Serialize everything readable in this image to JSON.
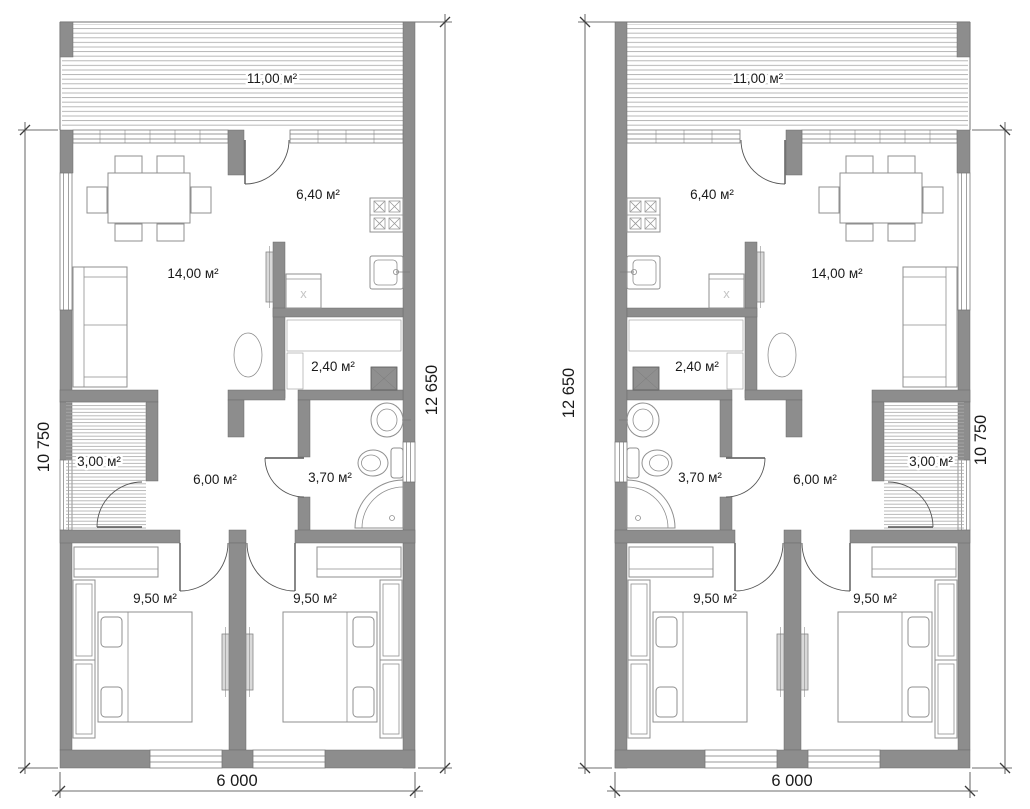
{
  "drawing": {
    "type": "architectural floor plan, two mirrored units",
    "units": "м²"
  },
  "plans": {
    "appliance_mark": "х",
    "left": {
      "rooms": {
        "terrace": "11,00 м²",
        "kitchen": "6,40 м²",
        "living": "14,00 м²",
        "sauna": "2,40 м²",
        "porch": "3,00 м²",
        "hall": "6,00 м²",
        "bath": "3,70 м²",
        "bed1": "9,50 м²",
        "bed2": "9,50 м²"
      },
      "dims": {
        "left": "10 750",
        "right": "12 650",
        "bottom": "6 000"
      }
    },
    "right": {
      "rooms": {
        "terrace": "11,00 м²",
        "kitchen": "6,40 м²",
        "living": "14,00 м²",
        "sauna": "2,40 м²",
        "porch": "3,00 м²",
        "hall": "6,00 м²",
        "bath": "3,70 м²",
        "bed1": "9,50 м²",
        "bed2": "9,50 м²"
      },
      "dims": {
        "left": "12 650",
        "right": "10 750",
        "bottom": "6 000"
      }
    }
  },
  "colors": {
    "wall": "#8d8d8d",
    "line": "#707070",
    "dimension": "#3d3d3d",
    "text": "#1a1a1a",
    "hatch": "#b0b0b0"
  }
}
